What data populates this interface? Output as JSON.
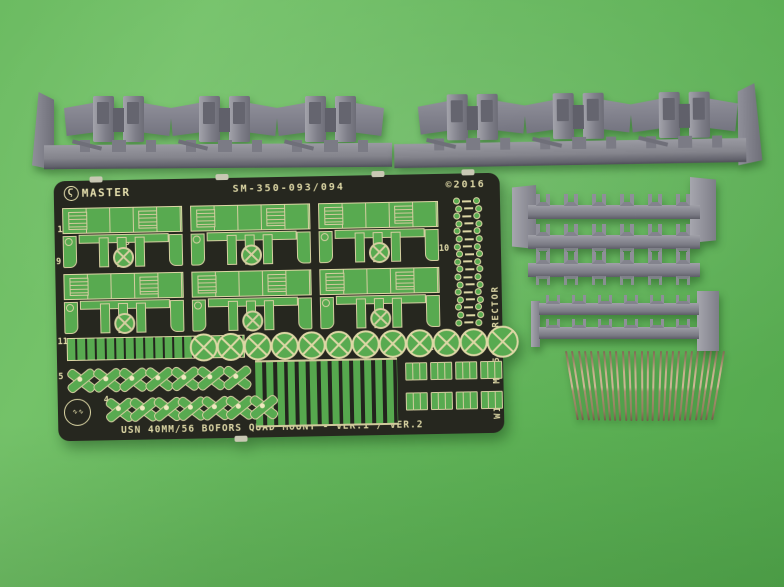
{
  "photo": {
    "background_green": "#63b55c",
    "description": "Model accessory set contents on green background: photo-etched fret, gray resin casting blocks, turned metal barrels"
  },
  "fret": {
    "brand": "MASTER",
    "set_number": "SM-350-093/094",
    "copyright": "©2016",
    "vertical_note": "WITH MK-51 DIRECTOR",
    "title": "USN 40MM/56 BOFORS QUAD MOUNT - VER.1 / VER.2",
    "plate_color": "#26271f",
    "etch_line_color": "#ddd7a5",
    "cutout_green": "#58aa50",
    "part_labels": [
      "1",
      "8",
      "9",
      "10",
      "11",
      "5",
      "4",
      "6",
      "7",
      "2",
      "3"
    ],
    "counts": {
      "shield_panels": 6,
      "handwheels": 12,
      "eyelet_rows": 17,
      "cross_parts_row5": 7,
      "cross_parts_row4": 7,
      "clip_parts_row2": 12,
      "clip_parts_row3": 12
    }
  },
  "resin": {
    "color": "#8b8b93",
    "left_block_assemblies": 3,
    "right_block_assemblies": 3,
    "large_rack_rows": 3,
    "large_rack_studs_per_row": 6,
    "small_rack_rows": 2,
    "small_rack_studs_per_row": 6
  },
  "barrels": {
    "count": 26,
    "color": "#b59a76"
  },
  "icons": {
    "master_logo": "Ϛ"
  }
}
